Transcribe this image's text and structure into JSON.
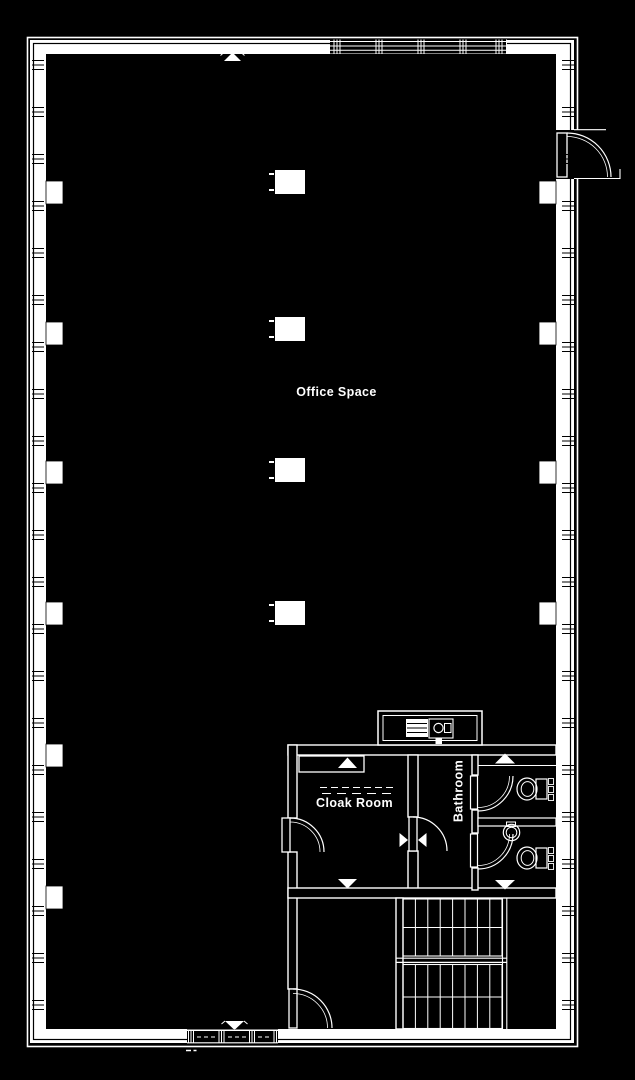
{
  "document": {
    "type": "architectural floor plan",
    "colors": {
      "background": "#000000",
      "lines": "#ffffff",
      "text": "#ffffff"
    }
  },
  "rooms": {
    "office_space": {
      "label": "Office Space"
    },
    "cloak_room": {
      "label": "Cloak Room"
    },
    "bathroom": {
      "label": "Bathroom"
    }
  },
  "features": [
    "window-band",
    "structural-column",
    "pilaster",
    "door-swing-arc",
    "door-direction-triangle",
    "coat-rail",
    "closet",
    "sink-unit",
    "toilet",
    "wash-basin",
    "toilet-stall",
    "staircase",
    "entrance-door"
  ],
  "counts": {
    "structural_columns": 4,
    "toilet_stalls": 2,
    "stair_flights": 2
  }
}
